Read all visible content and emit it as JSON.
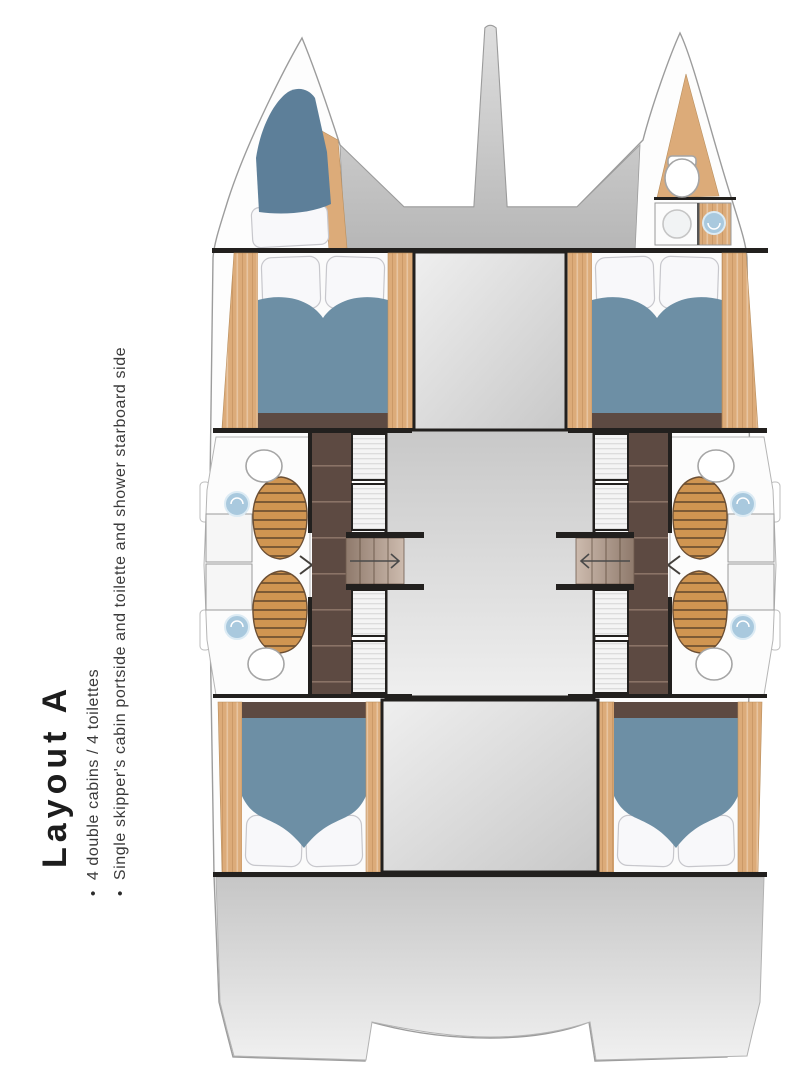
{
  "sidebar": {
    "title": "Layout A",
    "bullet_glyph": "•",
    "bullets": [
      "4 double cabins / 4 toilettes",
      "Single skipper's cabin portside and toilette and shower starboard side"
    ]
  },
  "diagram": {
    "type": "catamaran-deck-plan",
    "icons": [
      "toilet-icon",
      "sink-icon",
      "shower-floor-icon",
      "double-bed-icon",
      "single-bed-icon",
      "stairs-icon",
      "arrow-icon"
    ]
  },
  "colors": {
    "wall": "#22201e",
    "hull_fill": "#fdfdfd",
    "hull_stroke": "#9c9c9c",
    "bed_blue": "#6d8fa5",
    "skipper_bed_blue": "#5d7f99",
    "pillow": "#f8f8fa",
    "pillow_stroke": "#c7c7cc",
    "wood": "#dcab79",
    "teak": "#d09551",
    "teak_slat": "#7c5a35",
    "floor_brown": "#5d4a42",
    "plank_line": "#8a7366",
    "deck_top": "#dedede",
    "deck_bottom": "#b6b6b6",
    "stern_top": "#c6c6c6",
    "stern_bottom": "#f0f0f0",
    "saloon_top": "#c8c8c8",
    "saloon_bottom": "#efefef",
    "stairs_dark": "#8f7a6c",
    "stairs_light": "#cdbbae",
    "sink_blue": "#a9c9de",
    "cushion": "#f4f4f4",
    "cushion_line": "#dcdcdc",
    "text": "#2b2b2b"
  }
}
